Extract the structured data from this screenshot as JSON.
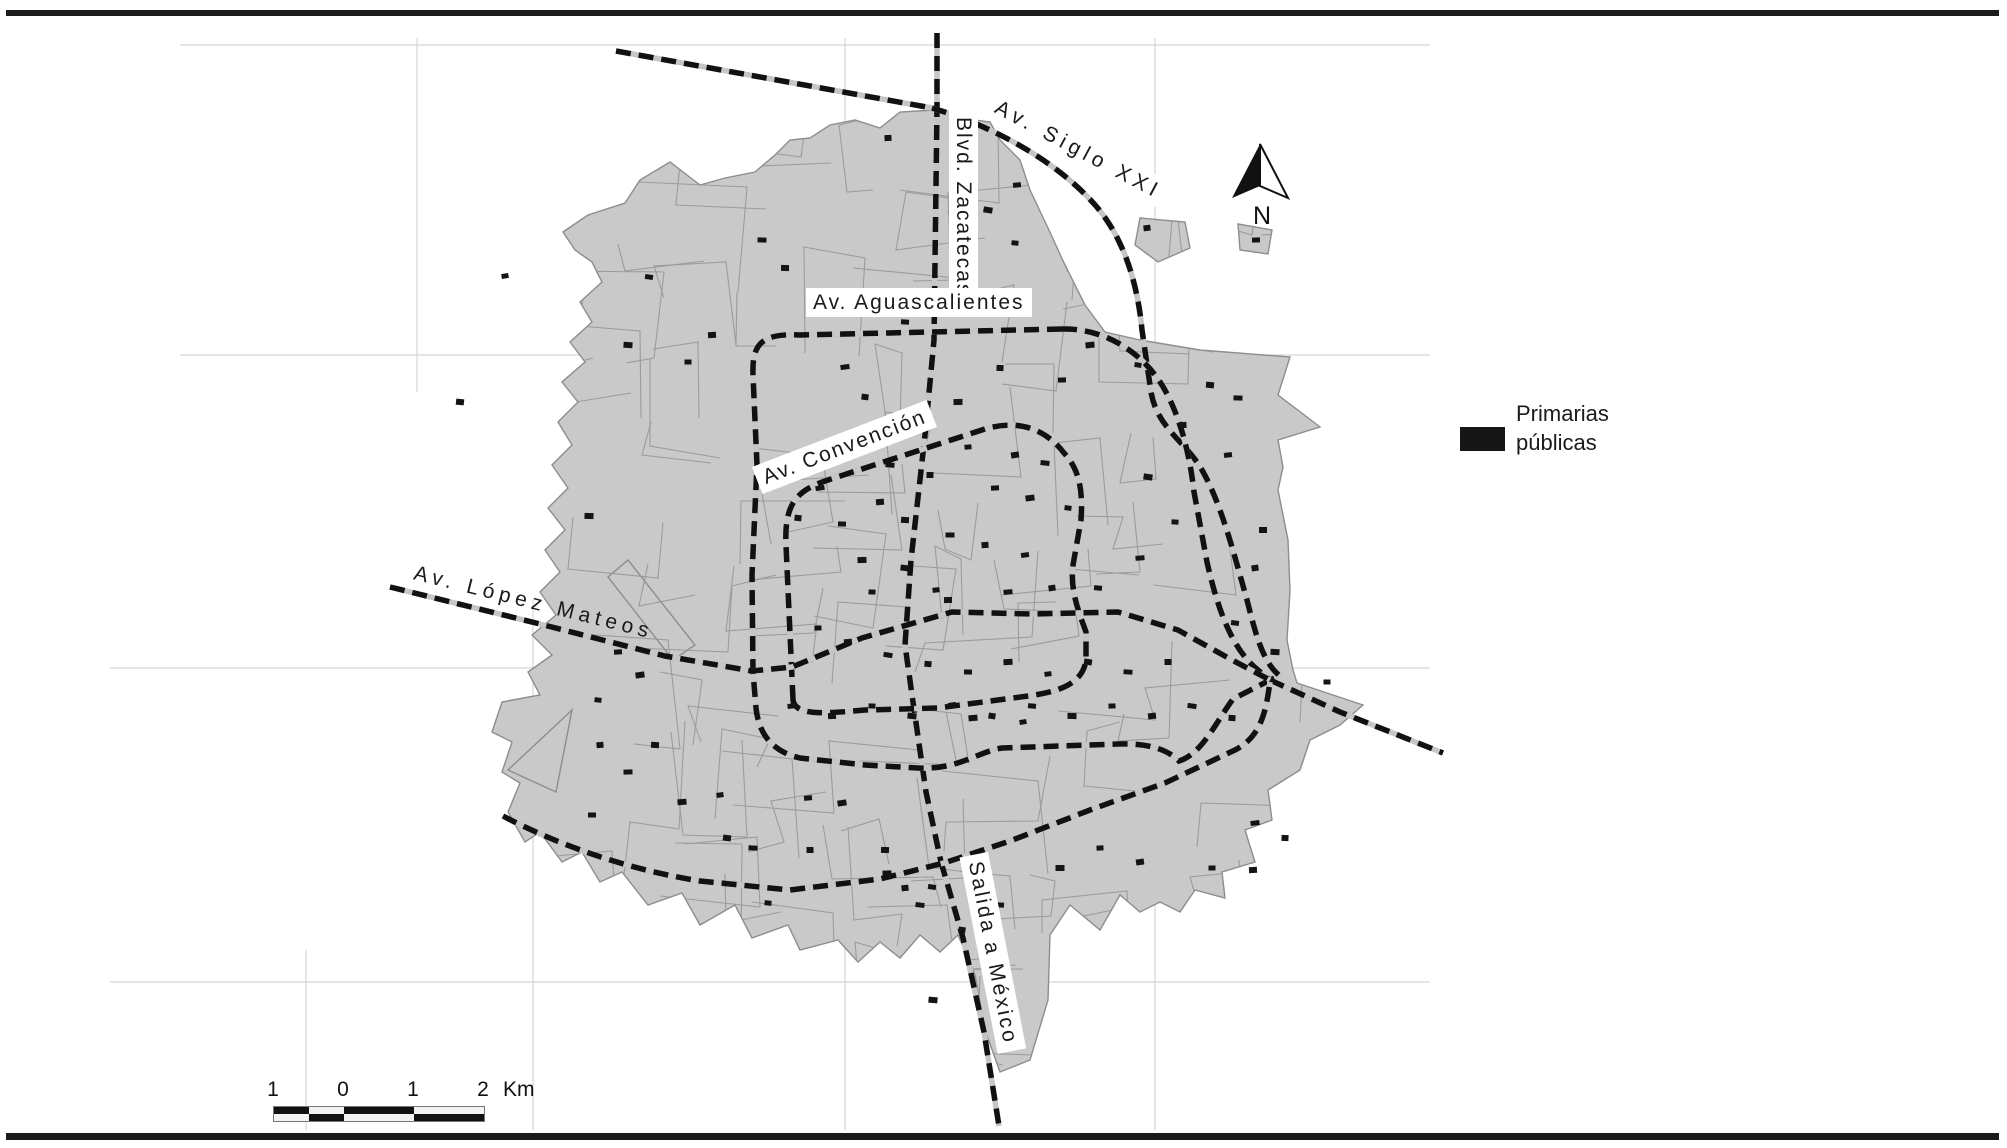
{
  "figure": {
    "background": "#ffffff",
    "border_color": "#1b1b1b"
  },
  "map": {
    "labels": [
      {
        "id": "blvd-zacatecas",
        "text": "Blvd. Zacatecas"
      },
      {
        "id": "av-siglo-xxi",
        "text": "Av. Siglo XXI"
      },
      {
        "id": "av-aguascalientes",
        "text": "Av. Aguascalientes"
      },
      {
        "id": "av-convencion",
        "text": "Av. Convención"
      },
      {
        "id": "av-lopez-mateos",
        "text": "Av. López Mateos"
      },
      {
        "id": "salida-a-mexico",
        "text": "Salida a México"
      }
    ],
    "legend": {
      "line1": "Primarias",
      "line2": "públicas",
      "swatch_color": "#161616"
    },
    "north": {
      "label": "N"
    },
    "scalebar": {
      "ticks": [
        "1",
        "0",
        "1",
        "2"
      ],
      "unit": "Km",
      "km_per_segment": 1
    },
    "colors": {
      "urban": "#c9c9c9",
      "urban_edge": "#8d8d8d",
      "street": "#979797",
      "road": "#111111",
      "road_casing": "#c6c6c6",
      "grid": "#d3d6d8",
      "school": "#141414"
    },
    "gridlines": {
      "horizontal": [
        {
          "y": 45,
          "x1": 180,
          "x2": 1430
        },
        {
          "y": 355,
          "x1": 180,
          "x2": 1430
        },
        {
          "y": 668,
          "x1": 110,
          "x2": 1430
        },
        {
          "y": 982,
          "x1": 110,
          "x2": 1430
        }
      ],
      "vertical": [
        {
          "x": 417,
          "y1": 38,
          "y2": 392
        },
        {
          "x": 533,
          "y1": 600,
          "y2": 1130
        },
        {
          "x": 306,
          "y1": 950,
          "y2": 1130
        },
        {
          "x": 845,
          "y1": 38,
          "y2": 1130
        },
        {
          "x": 1155,
          "y1": 38,
          "y2": 1130
        }
      ]
    },
    "urban_outline": [
      [
        935,
        110
      ],
      [
        960,
        118
      ],
      [
        990,
        122
      ],
      [
        1000,
        140
      ],
      [
        1020,
        160
      ],
      [
        1030,
        190
      ],
      [
        1048,
        228
      ],
      [
        1065,
        265
      ],
      [
        1085,
        305
      ],
      [
        1105,
        332
      ],
      [
        1140,
        340
      ],
      [
        1200,
        350
      ],
      [
        1290,
        357
      ],
      [
        1278,
        395
      ],
      [
        1320,
        427
      ],
      [
        1278,
        440
      ],
      [
        1283,
        467
      ],
      [
        1278,
        490
      ],
      [
        1288,
        540
      ],
      [
        1290,
        590
      ],
      [
        1287,
        640
      ],
      [
        1293,
        670
      ],
      [
        1297,
        683
      ],
      [
        1363,
        705
      ],
      [
        1340,
        725
      ],
      [
        1310,
        740
      ],
      [
        1300,
        770
      ],
      [
        1268,
        790
      ],
      [
        1272,
        820
      ],
      [
        1245,
        830
      ],
      [
        1255,
        862
      ],
      [
        1222,
        872
      ],
      [
        1225,
        898
      ],
      [
        1195,
        890
      ],
      [
        1180,
        912
      ],
      [
        1160,
        902
      ],
      [
        1140,
        912
      ],
      [
        1120,
        895
      ],
      [
        1100,
        930
      ],
      [
        1070,
        905
      ],
      [
        1050,
        935
      ],
      [
        1048,
        1000
      ],
      [
        1030,
        1060
      ],
      [
        1000,
        1072
      ],
      [
        985,
        1030
      ],
      [
        975,
        975
      ],
      [
        958,
        935
      ],
      [
        940,
        952
      ],
      [
        920,
        935
      ],
      [
        900,
        958
      ],
      [
        880,
        942
      ],
      [
        858,
        962
      ],
      [
        838,
        940
      ],
      [
        800,
        950
      ],
      [
        788,
        925
      ],
      [
        752,
        938
      ],
      [
        735,
        905
      ],
      [
        700,
        925
      ],
      [
        682,
        893
      ],
      [
        648,
        905
      ],
      [
        622,
        872
      ],
      [
        600,
        882
      ],
      [
        582,
        852
      ],
      [
        562,
        862
      ],
      [
        540,
        832
      ],
      [
        525,
        842
      ],
      [
        508,
        812
      ],
      [
        520,
        783
      ],
      [
        502,
        772
      ],
      [
        512,
        742
      ],
      [
        492,
        732
      ],
      [
        502,
        702
      ],
      [
        540,
        695
      ],
      [
        528,
        672
      ],
      [
        552,
        655
      ],
      [
        532,
        635
      ],
      [
        556,
        615
      ],
      [
        540,
        592
      ],
      [
        560,
        572
      ],
      [
        545,
        550
      ],
      [
        565,
        530
      ],
      [
        548,
        508
      ],
      [
        568,
        488
      ],
      [
        552,
        465
      ],
      [
        572,
        445
      ],
      [
        558,
        422
      ],
      [
        578,
        402
      ],
      [
        562,
        382
      ],
      [
        585,
        362
      ],
      [
        570,
        342
      ],
      [
        592,
        322
      ],
      [
        580,
        302
      ],
      [
        602,
        282
      ],
      [
        592,
        262
      ],
      [
        575,
        250
      ],
      [
        563,
        232
      ],
      [
        588,
        215
      ],
      [
        625,
        203
      ],
      [
        640,
        180
      ],
      [
        670,
        162
      ],
      [
        700,
        185
      ],
      [
        725,
        178
      ],
      [
        755,
        172
      ],
      [
        775,
        155
      ],
      [
        790,
        140
      ],
      [
        810,
        138
      ],
      [
        830,
        125
      ],
      [
        855,
        120
      ],
      [
        880,
        128
      ],
      [
        900,
        112
      ]
    ],
    "urban_islands": [
      [
        [
          1140,
          218
        ],
        [
          1185,
          222
        ],
        [
          1190,
          248
        ],
        [
          1158,
          262
        ],
        [
          1135,
          245
        ]
      ],
      [
        [
          1238,
          224
        ],
        [
          1272,
          230
        ],
        [
          1268,
          254
        ],
        [
          1240,
          250
        ]
      ],
      [
        [
          608,
          577
        ],
        [
          628,
          560
        ],
        [
          695,
          645
        ],
        [
          673,
          660
        ]
      ],
      [
        [
          508,
          770
        ],
        [
          572,
          710
        ],
        [
          556,
          792
        ]
      ]
    ],
    "roads": [
      {
        "id": "road-nw-diagonal",
        "d": "M616,51 L932,108"
      },
      {
        "id": "road-blvd-zacatecas",
        "d": "M937,33 L937,108 L934,340 L925,435 L911,560 L905,645 L913,702 L926,792 L941,862"
      },
      {
        "id": "road-salida-a-mexico",
        "d": "M941,862 L963,938 L984,1032 L999,1126"
      },
      {
        "id": "road-av-siglo-xxi",
        "d": "M932,108 C992,126 1056,160 1096,206 C1126,241 1138,288 1142,330 L1151,392 C1157,428 1186,442 1202,470 C1222,505 1235,558 1247,600 C1255,631 1262,662 1280,676 L1270,680"
      },
      {
        "id": "road-siglo-se-exit",
        "d": "M1270,680 L1340,712 L1443,753"
      },
      {
        "id": "road-ring-aguascalientes-w",
        "d": "M1062,329 L800,335 C760,333 752,345 753,375 L757,465 L752,575 L753,672 L756,708 C759,736 774,752 800,758 L865,765 L918,768 C958,770 977,752 1002,748 L1118,744 C1150,743 1168,750 1179,761 C1202,754 1216,722 1233,699 L1270,680"
      },
      {
        "id": "road-ring-aguascalientes-e",
        "d": "M1062,329 C1108,328 1147,356 1166,392 C1181,420 1190,456 1194,492 L1207,562 C1216,602 1230,648 1258,670 L1270,680"
      },
      {
        "id": "road-ring-convencion",
        "d": "M793,700 L786,545 C784,502 798,490 828,480 L985,429 C1022,418 1048,432 1064,453 C1080,470 1083,492 1081,520 L1073,565 C1070,590 1078,610 1086,632 L1086,660 C1083,684 1058,692 1028,696 L938,708 L865,710 C830,713 795,717 793,700 Z"
      },
      {
        "id": "road-av-lopez-mateos",
        "d": "M390,587 L540,624 L665,656 L752,671 L792,667 L862,638 L952,612 L1032,614 L1118,612 L1178,630 L1232,660 L1270,680"
      },
      {
        "id": "road-south-sweep",
        "d": "M503,816 C560,846 630,870 700,881 L790,890 L880,879 L944,863 L1010,841 L1090,810 L1165,783 L1235,750 C1262,736 1266,710 1270,682"
      }
    ],
    "schools": [
      [
        505,
        276
      ],
      [
        460,
        402
      ],
      [
        762,
        240
      ],
      [
        888,
        138
      ],
      [
        1017,
        185
      ],
      [
        988,
        210
      ],
      [
        1015,
        243
      ],
      [
        785,
        268
      ],
      [
        1122,
        182
      ],
      [
        1147,
        228
      ],
      [
        649,
        277
      ],
      [
        628,
        345
      ],
      [
        688,
        362
      ],
      [
        712,
        335
      ],
      [
        845,
        367
      ],
      [
        865,
        397
      ],
      [
        905,
        322
      ],
      [
        958,
        402
      ],
      [
        968,
        447
      ],
      [
        1015,
        455
      ],
      [
        1045,
        463
      ],
      [
        1000,
        368
      ],
      [
        1062,
        380
      ],
      [
        1090,
        345
      ],
      [
        1138,
        365
      ],
      [
        1210,
        385
      ],
      [
        1238,
        398
      ],
      [
        1183,
        425
      ],
      [
        1228,
        455
      ],
      [
        1148,
        477
      ],
      [
        1175,
        522
      ],
      [
        1263,
        530
      ],
      [
        1140,
        558
      ],
      [
        1255,
        568
      ],
      [
        1235,
        623
      ],
      [
        1275,
        652
      ],
      [
        1327,
        682
      ],
      [
        880,
        502
      ],
      [
        820,
        488
      ],
      [
        798,
        518
      ],
      [
        842,
        524
      ],
      [
        862,
        560
      ],
      [
        936,
        590
      ],
      [
        908,
        430
      ],
      [
        890,
        465
      ],
      [
        930,
        475
      ],
      [
        995,
        488
      ],
      [
        1030,
        498
      ],
      [
        1068,
        508
      ],
      [
        905,
        520
      ],
      [
        950,
        535
      ],
      [
        985,
        545
      ],
      [
        1025,
        555
      ],
      [
        905,
        568
      ],
      [
        872,
        592
      ],
      [
        948,
        600
      ],
      [
        1008,
        592
      ],
      [
        1052,
        588
      ],
      [
        1098,
        588
      ],
      [
        589,
        516
      ],
      [
        818,
        628
      ],
      [
        848,
        642
      ],
      [
        888,
        655
      ],
      [
        928,
        664
      ],
      [
        968,
        672
      ],
      [
        1008,
        662
      ],
      [
        1048,
        674
      ],
      [
        1088,
        662
      ],
      [
        1128,
        672
      ],
      [
        1168,
        662
      ],
      [
        618,
        652
      ],
      [
        640,
        675
      ],
      [
        598,
        700
      ],
      [
        655,
        745
      ],
      [
        628,
        772
      ],
      [
        600,
        745
      ],
      [
        952,
        705
      ],
      [
        912,
        716
      ],
      [
        872,
        706
      ],
      [
        832,
        716
      ],
      [
        792,
        706
      ],
      [
        992,
        716
      ],
      [
        1032,
        706
      ],
      [
        1072,
        716
      ],
      [
        1112,
        706
      ],
      [
        1152,
        716
      ],
      [
        1192,
        706
      ],
      [
        1232,
        718
      ],
      [
        592,
        815
      ],
      [
        682,
        802
      ],
      [
        720,
        795
      ],
      [
        727,
        838
      ],
      [
        753,
        848
      ],
      [
        810,
        850
      ],
      [
        808,
        798
      ],
      [
        842,
        803
      ],
      [
        768,
        903
      ],
      [
        885,
        850
      ],
      [
        887,
        873
      ],
      [
        905,
        888
      ],
      [
        932,
        887
      ],
      [
        933,
        1000
      ],
      [
        1212,
        868
      ],
      [
        1253,
        870
      ],
      [
        1255,
        823
      ],
      [
        962,
        930
      ],
      [
        1000,
        905
      ],
      [
        1060,
        868
      ],
      [
        1100,
        848
      ],
      [
        1140,
        862
      ],
      [
        920,
        905
      ],
      [
        1285,
        838
      ],
      [
        1256,
        240
      ],
      [
        973,
        718
      ],
      [
        1023,
        722
      ]
    ]
  }
}
